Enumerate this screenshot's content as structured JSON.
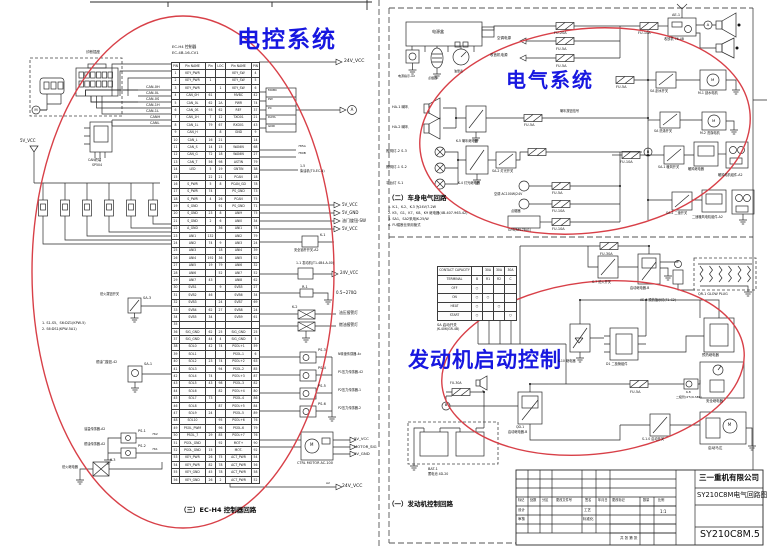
{
  "colors": {
    "highlight_ellipse": "#d84048",
    "heading_blue": "#1717e0",
    "line": "#2a2a2a",
    "paper": "#ffffff"
  },
  "headings": {
    "hl": "电控系统",
    "hr": "电气系统",
    "hb": "发动机启动控制"
  },
  "captions": {
    "c1": "（一）发动机控制回路",
    "c2": "（二）车身电气回路",
    "c3": "（三）EC-H4 控制器回路"
  },
  "ecu": {
    "h1": "EC-H4 控制器",
    "h2": "EC-4B-16-CV1",
    "rows": [
      [
        "PIN",
        "Pin NAME",
        "Pin",
        "LOC",
        "Pin NAME",
        "PIN"
      ],
      [
        "1",
        "KEY_PWR",
        "",
        "",
        "KEY_SW",
        "4"
      ],
      [
        "2",
        "KEY_PWR",
        "1",
        "",
        "KEY_SW",
        "5"
      ],
      [
        "3",
        "KEY_PWR",
        "",
        "1",
        "KEY_SW",
        "6"
      ],
      [
        "4",
        "CAN_0H",
        "61",
        "",
        "MVBC",
        "42"
      ],
      [
        "5",
        "CAN_0L",
        "62",
        "2A",
        "PWR",
        "74"
      ],
      [
        "6",
        "CAN_0S",
        "93",
        "62",
        "REF",
        "37"
      ],
      [
        "7",
        "CAN_1H",
        "7",
        "12",
        "TXD01",
        "21"
      ],
      [
        "8",
        "CAN_1L",
        "79",
        "67",
        "RXD01",
        "43"
      ],
      [
        "9",
        "CAN_H",
        "",
        "8",
        "GND",
        "9"
      ],
      [
        "10",
        "CAN_L",
        "16",
        "21",
        "",
        "14"
      ],
      [
        "11",
        "CAN_S",
        "14",
        "15",
        "WANIN",
        "68"
      ],
      [
        "12",
        "CAN_G",
        "72",
        "18",
        "WANIN",
        "27"
      ],
      [
        "13",
        "CAN_T",
        "56",
        "98",
        "ASTIN",
        "79"
      ],
      [
        "14",
        "LED",
        "5",
        "19",
        "GNTIN",
        "38"
      ],
      [
        "15",
        "",
        "22",
        "21",
        "PCAN",
        "18"
      ],
      [
        "16",
        "S_PWR",
        "5",
        "8",
        "PCAN_GD",
        "78"
      ],
      [
        "17",
        "S_PWR",
        "74",
        "",
        "PS_GND",
        "73"
      ],
      [
        "18",
        "S_PWR",
        "4",
        "26",
        "PCAN",
        "75"
      ],
      [
        "19",
        "S_GND",
        "",
        "91",
        "PS_GND",
        "71"
      ],
      [
        "20",
        "S_GND",
        "23",
        "8",
        "ANI9",
        "75"
      ],
      [
        "21",
        "S_GND",
        "2",
        "6",
        "ANI0",
        "34"
      ],
      [
        "22",
        "A_GND",
        "",
        "36",
        "ANI1",
        "74"
      ],
      [
        "23",
        "ANI1",
        "132",
        "",
        "ANI2",
        "79"
      ],
      [
        "24",
        "ANI2",
        "74",
        "9",
        "ANI3",
        "24"
      ],
      [
        "25",
        "ANI3",
        "",
        "18",
        "ANI4",
        "39"
      ],
      [
        "26",
        "ANI4",
        "192",
        "36",
        "ANI5",
        "52"
      ],
      [
        "27",
        "ANI5",
        "19",
        "79",
        "ANI6",
        "32"
      ],
      [
        "28",
        "ANI6",
        "",
        "52",
        "ANI7",
        "52"
      ],
      [
        "29",
        "ANI7",
        "43",
        "",
        "ANI8",
        "62"
      ],
      [
        "30",
        "SVB1",
        "",
        "9",
        "SVB5",
        "27"
      ],
      [
        "31",
        "SVB2",
        "46",
        "",
        "SVB6",
        "34"
      ],
      [
        "32",
        "SVB3",
        "",
        "24",
        "SVB7",
        "69"
      ],
      [
        "33",
        "SVB4",
        "62",
        "27",
        "SVB8",
        "24"
      ],
      [
        "34",
        "SVB5",
        "34",
        "",
        "SVB9",
        "61"
      ],
      [
        "35",
        "",
        "",
        "",
        "",
        ""
      ],
      [
        "36",
        "SIG_GND",
        "62",
        "25",
        "SIG_GND",
        "25"
      ],
      [
        "37",
        "SIG_GND",
        "44",
        "4",
        "SIG_GND",
        "5"
      ],
      [
        "38",
        "SOL0",
        "42",
        "74",
        "PSOL+1",
        "59"
      ],
      [
        "39",
        "SOL1",
        "",
        "",
        "PSOL-1",
        "6"
      ],
      [
        "40",
        "SOL2",
        "23",
        "74",
        "PSOL+2",
        "63"
      ],
      [
        "41",
        "SOL3",
        "",
        "94",
        "PSOL-2",
        "85"
      ],
      [
        "42",
        "SOL4",
        "74",
        "",
        "PSOL+3",
        "87"
      ],
      [
        "43",
        "SOL5",
        "43",
        "98",
        "PSOL-3",
        "82"
      ],
      [
        "44",
        "SOL6",
        "",
        "82",
        "PSOL+4",
        "80"
      ],
      [
        "45",
        "SOL7",
        "73",
        "",
        "PSOL-4",
        "86"
      ],
      [
        "46",
        "SOL8",
        "",
        "87",
        "PSOL+5",
        "84"
      ],
      [
        "47",
        "SOL9",
        "24",
        "",
        "PSOL-5",
        "89"
      ],
      [
        "48",
        "SOL10",
        "",
        "95",
        "PSOL+6",
        "76"
      ],
      [
        "49",
        "PSOL_PWM",
        "",
        "96",
        "PSOL-6",
        "79"
      ],
      [
        "50",
        "PSOL_7",
        "29",
        "85",
        "PSOL+7",
        "76"
      ],
      [
        "51",
        "PSOL_GND",
        "",
        "92",
        "MOT+",
        "90"
      ],
      [
        "52",
        "PSOL_GND",
        "15",
        "",
        "MOT-",
        "92"
      ],
      [
        "53",
        "KEY_PWR",
        "26",
        "75",
        "ACT_PWR",
        "54"
      ],
      [
        "54",
        "KEY_PWR",
        "82",
        "78",
        "ACT_PWR",
        "56"
      ],
      [
        "55",
        "KEY_GND",
        "45",
        "78",
        "ACT_PWR",
        "58"
      ],
      [
        "56",
        "KEY_GND",
        "26",
        "2",
        "ACT_PWR",
        "52"
      ]
    ]
  },
  "contact": {
    "rows": [
      [
        "CONTACT CAPACITY",
        "",
        "30A",
        "30A",
        "30A"
      ],
      [
        "TERMINAL",
        "B",
        "R1",
        "R2",
        "C"
      ],
      [
        "OFF",
        "○",
        "",
        "",
        ""
      ],
      [
        "ON",
        "○",
        "○",
        "",
        ""
      ],
      [
        "HEAT",
        "○",
        "",
        "○",
        ""
      ],
      [
        "START",
        "○",
        "",
        "",
        "○"
      ]
    ],
    "l1": "SA 启动开关",
    "l2": "JK-406(GR-4B)"
  },
  "lp": {
    "vcc24a": "24V_VCC",
    "vcc24b": "24V_VCC",
    "vcc24c": "24V_VCC",
    "can0": [
      "CAN-0H",
      "CAN-0L",
      "CAN-0S",
      "CAN-1H",
      "CAN-1L"
    ],
    "can2": [
      "CANH",
      "CANL"
    ],
    "diag": "诊断插座",
    "ic1": "CAN终端",
    "ic2": "SP504",
    "mlet": "M",
    "v5": "5V_VCC",
    "sens1": "1. S1-S5、S6:DZ1(KPW-5)",
    "sens2": "2. S6:DS1(KPW-5A1)",
    "sw1": "SA-3",
    "sw1d": "熄火拨钮开关",
    "sw2": "SA-1",
    "sw2d": "燃油门旋钮-42",
    "ps1": "PS-1",
    "ps1d": "油温传感器-A2",
    "ps2": "PS-2",
    "ps2d": "燃油传感器-A2",
    "n762": "762",
    "n761": "761",
    "k3": "K-3",
    "k3d": "熄火继电器",
    "conn": [
      "MOBC",
      "PW",
      "PC",
      "DATA",
      "GND"
    ],
    "ca": "A",
    "n785a": "785A",
    "n785b": "780B",
    "l15a": "1-5",
    "l15b": "柴油机(T0-EC-4)",
    "ra": [
      "5V_VCC",
      "5V_GND",
      "油门旋钮-SW",
      "5V_VCC"
    ],
    "k1": "K-1",
    "k1d": "安全锁杆开关-A2",
    "eng": "1-1 发动机(T1-4B4-A-00)",
    "r1": "R-1",
    "r1d": "0.5~270Ω",
    "k2": "K-2",
    "k2a": "油压报警灯",
    "k2b": "燃油报警灯",
    "ps": [
      "PS-3",
      "PS-4",
      "PS-5",
      "PS-6"
    ],
    "psd": [
      "N转速传感器-4c",
      "P1压力传感器-42",
      "P2压力传感器-1",
      "P2压力传感器-2"
    ],
    "mm": "M",
    "md": "CTRL MOTOR AC-100",
    "ma": [
      "5V_VCC",
      "MOTOR_SIG",
      "5V_GND"
    ],
    "a2": "A2"
  },
  "rt": {
    "pb": "电源盒",
    "pc": [
      "电源指示-A2",
      "点烟器",
      "油量表"
    ],
    "f": [
      "FU-20A",
      "FU-5A",
      "FU-5A",
      "FU-10A",
      "FU-5A",
      "FU-5A",
      "FU-10A",
      "FU-5A",
      "FU-10A",
      "FU-10A",
      "FU-10A"
    ],
    "la": [
      "空调电源",
      "收音机电源"
    ],
    "ae": "AE-1",
    "aed": "收放机 76-4B",
    "caA": "A",
    "cbB": "B",
    "ws": "SA 刮水开关",
    "wm": "M-1 刮水电机",
    "wml": "M",
    "h1": "HA-1 喇叭",
    "h2": "HA-2 喇叭",
    "k5": "K-5 喇叭继电器",
    "hs": "喇叭按钮信号",
    "lamps": [
      "照明灯-2  S-3",
      "照明灯-1  S-2",
      "平台灯  S-1"
    ],
    "k4": "K-4 灯光继电器",
    "ls": "SA-2 灯光开关",
    "ac": "空调 AC100W/24V",
    "cig": "点烟器",
    "gps": "GPS(AM-7841)",
    "hs1": "SA-1 暖风开关",
    "hr": "暖风继电器",
    "hu": "暖风电机组件-A2",
    "h2s": "SA-2 二速开关",
    "h2u": "二速暖风电机组件-A2",
    "washs": "SA 洗涤开关",
    "washm": "M-2 洗涤电机",
    "m2": "M"
  },
  "rb": {
    "f30": "FU-30A",
    "s7": "S-7 熄火开关",
    "qd": "启动继电器-B",
    "glow": "QR-1 GLOW PLUG",
    "ae7": "AE-7 预热指示灯(F1-C2)",
    "ph": "预热继电器",
    "k10": "K-10 继电器",
    "d1": "D1 二极管组件",
    "f5": "FU-5A",
    "k8a": "K-8",
    "k8b": "二极管(4'5/9-SBL)",
    "sr": "安全继电器",
    "sm": "启动马达",
    "sml": "M",
    "s10": "S-1.0 启动开关",
    "qd2a": "QD-1",
    "qd2b": "启动继电器-B",
    "f30b": "FU-30A",
    "bat": "BAT-1",
    "batd": "蓄电池 4D-20",
    "cb": "B"
  },
  "notes": {
    "n": [
      "1. K-1、K-2、K-3 为24V/7-2W",
      "2. K5、G1、K7、K8、K9 继电器(4B-407-963-42)",
      "3. SA1、SA2采用JK-25/W",
      "4. FU熔断丝采用管式"
    ]
  },
  "tb": {
    "company": "三一重机有限公司",
    "title": "SY210C8M电气回路图",
    "no": "SY210C8M.5",
    "scale": "1:1",
    "cols": [
      "标记",
      "处数",
      "分区",
      "更改文件号",
      "签名",
      "年月日"
    ],
    "r1a": "设计",
    "r1b": "工艺",
    "r2a": "审核",
    "r2b": "标准化",
    "mk": "更改标记",
    "qty": "数量",
    "ratio": "比例",
    "sheet": "共 张 第 张"
  }
}
